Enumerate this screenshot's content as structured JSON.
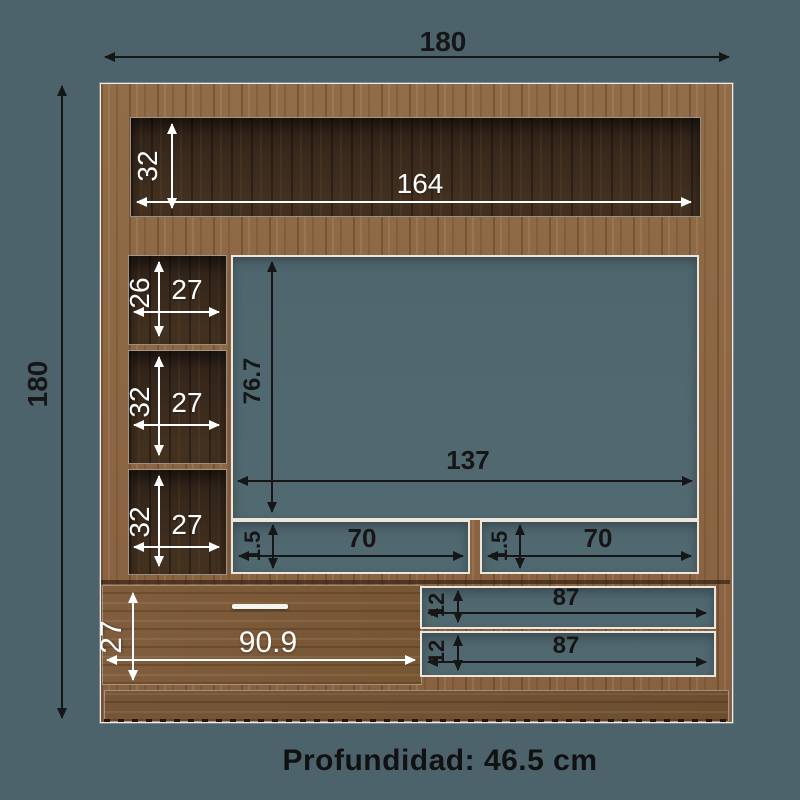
{
  "diagram": {
    "depth_note": "Profundidad: 46.5 cm",
    "overall": {
      "width": "180",
      "height": "180"
    },
    "top_shelf": {
      "height": "32",
      "width": "164"
    },
    "left_cubbies": [
      {
        "height": "26",
        "width": "27"
      },
      {
        "height": "32",
        "width": "27"
      },
      {
        "height": "32",
        "width": "27"
      }
    ],
    "tv_opening": {
      "height": "76.7",
      "width": "137"
    },
    "media_slots": [
      {
        "height": "1.5",
        "width": "70"
      },
      {
        "height": "1.5",
        "width": "70"
      }
    ],
    "drawer": {
      "height": "27",
      "width": "90.9"
    },
    "bottom_shelves": [
      {
        "height": "12",
        "width": "87"
      },
      {
        "height": "12",
        "width": "87"
      }
    ],
    "colors": {
      "background": "#4d636b",
      "wood_light": "#8d6845",
      "wood_dark_interior": "#3a2b1d",
      "dim_black": "#161616",
      "dim_white": "#ffffff"
    }
  }
}
